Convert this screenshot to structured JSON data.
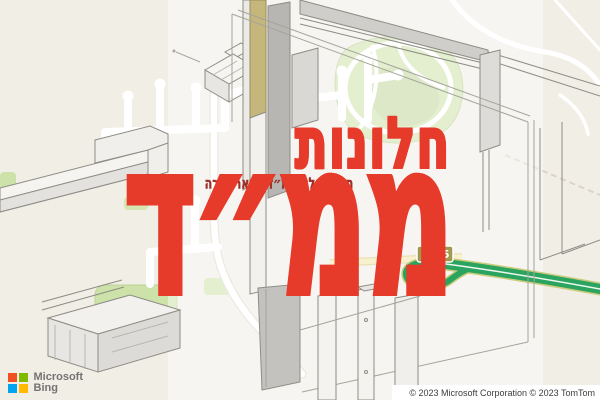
{
  "watermark": {
    "title_line1": "חלונות",
    "title_line2": "ממ״ד",
    "tagline": "תיקון חלון ממ״ד בבאר אורה",
    "star_icon": "★",
    "color_primary": "#e63a2b",
    "color_tagline": "#9c2f28"
  },
  "map": {
    "route_shield": "1095",
    "colors": {
      "land": "#f1eee6",
      "park_green": "#cde2a9",
      "highway_green": "#2aa45f",
      "highway_casing": "#c9cc7c",
      "road_yellow": "#f3e6a8",
      "shield_background": "#a3984f"
    }
  },
  "logo": {
    "brand_line1": "Microsoft",
    "brand_line2": "Bing",
    "square_colors": [
      "#f25022",
      "#7fba00",
      "#00a4ef",
      "#ffb900"
    ]
  },
  "attribution": {
    "text": "© 2023 Microsoft Corporation © 2023 TomTom"
  }
}
